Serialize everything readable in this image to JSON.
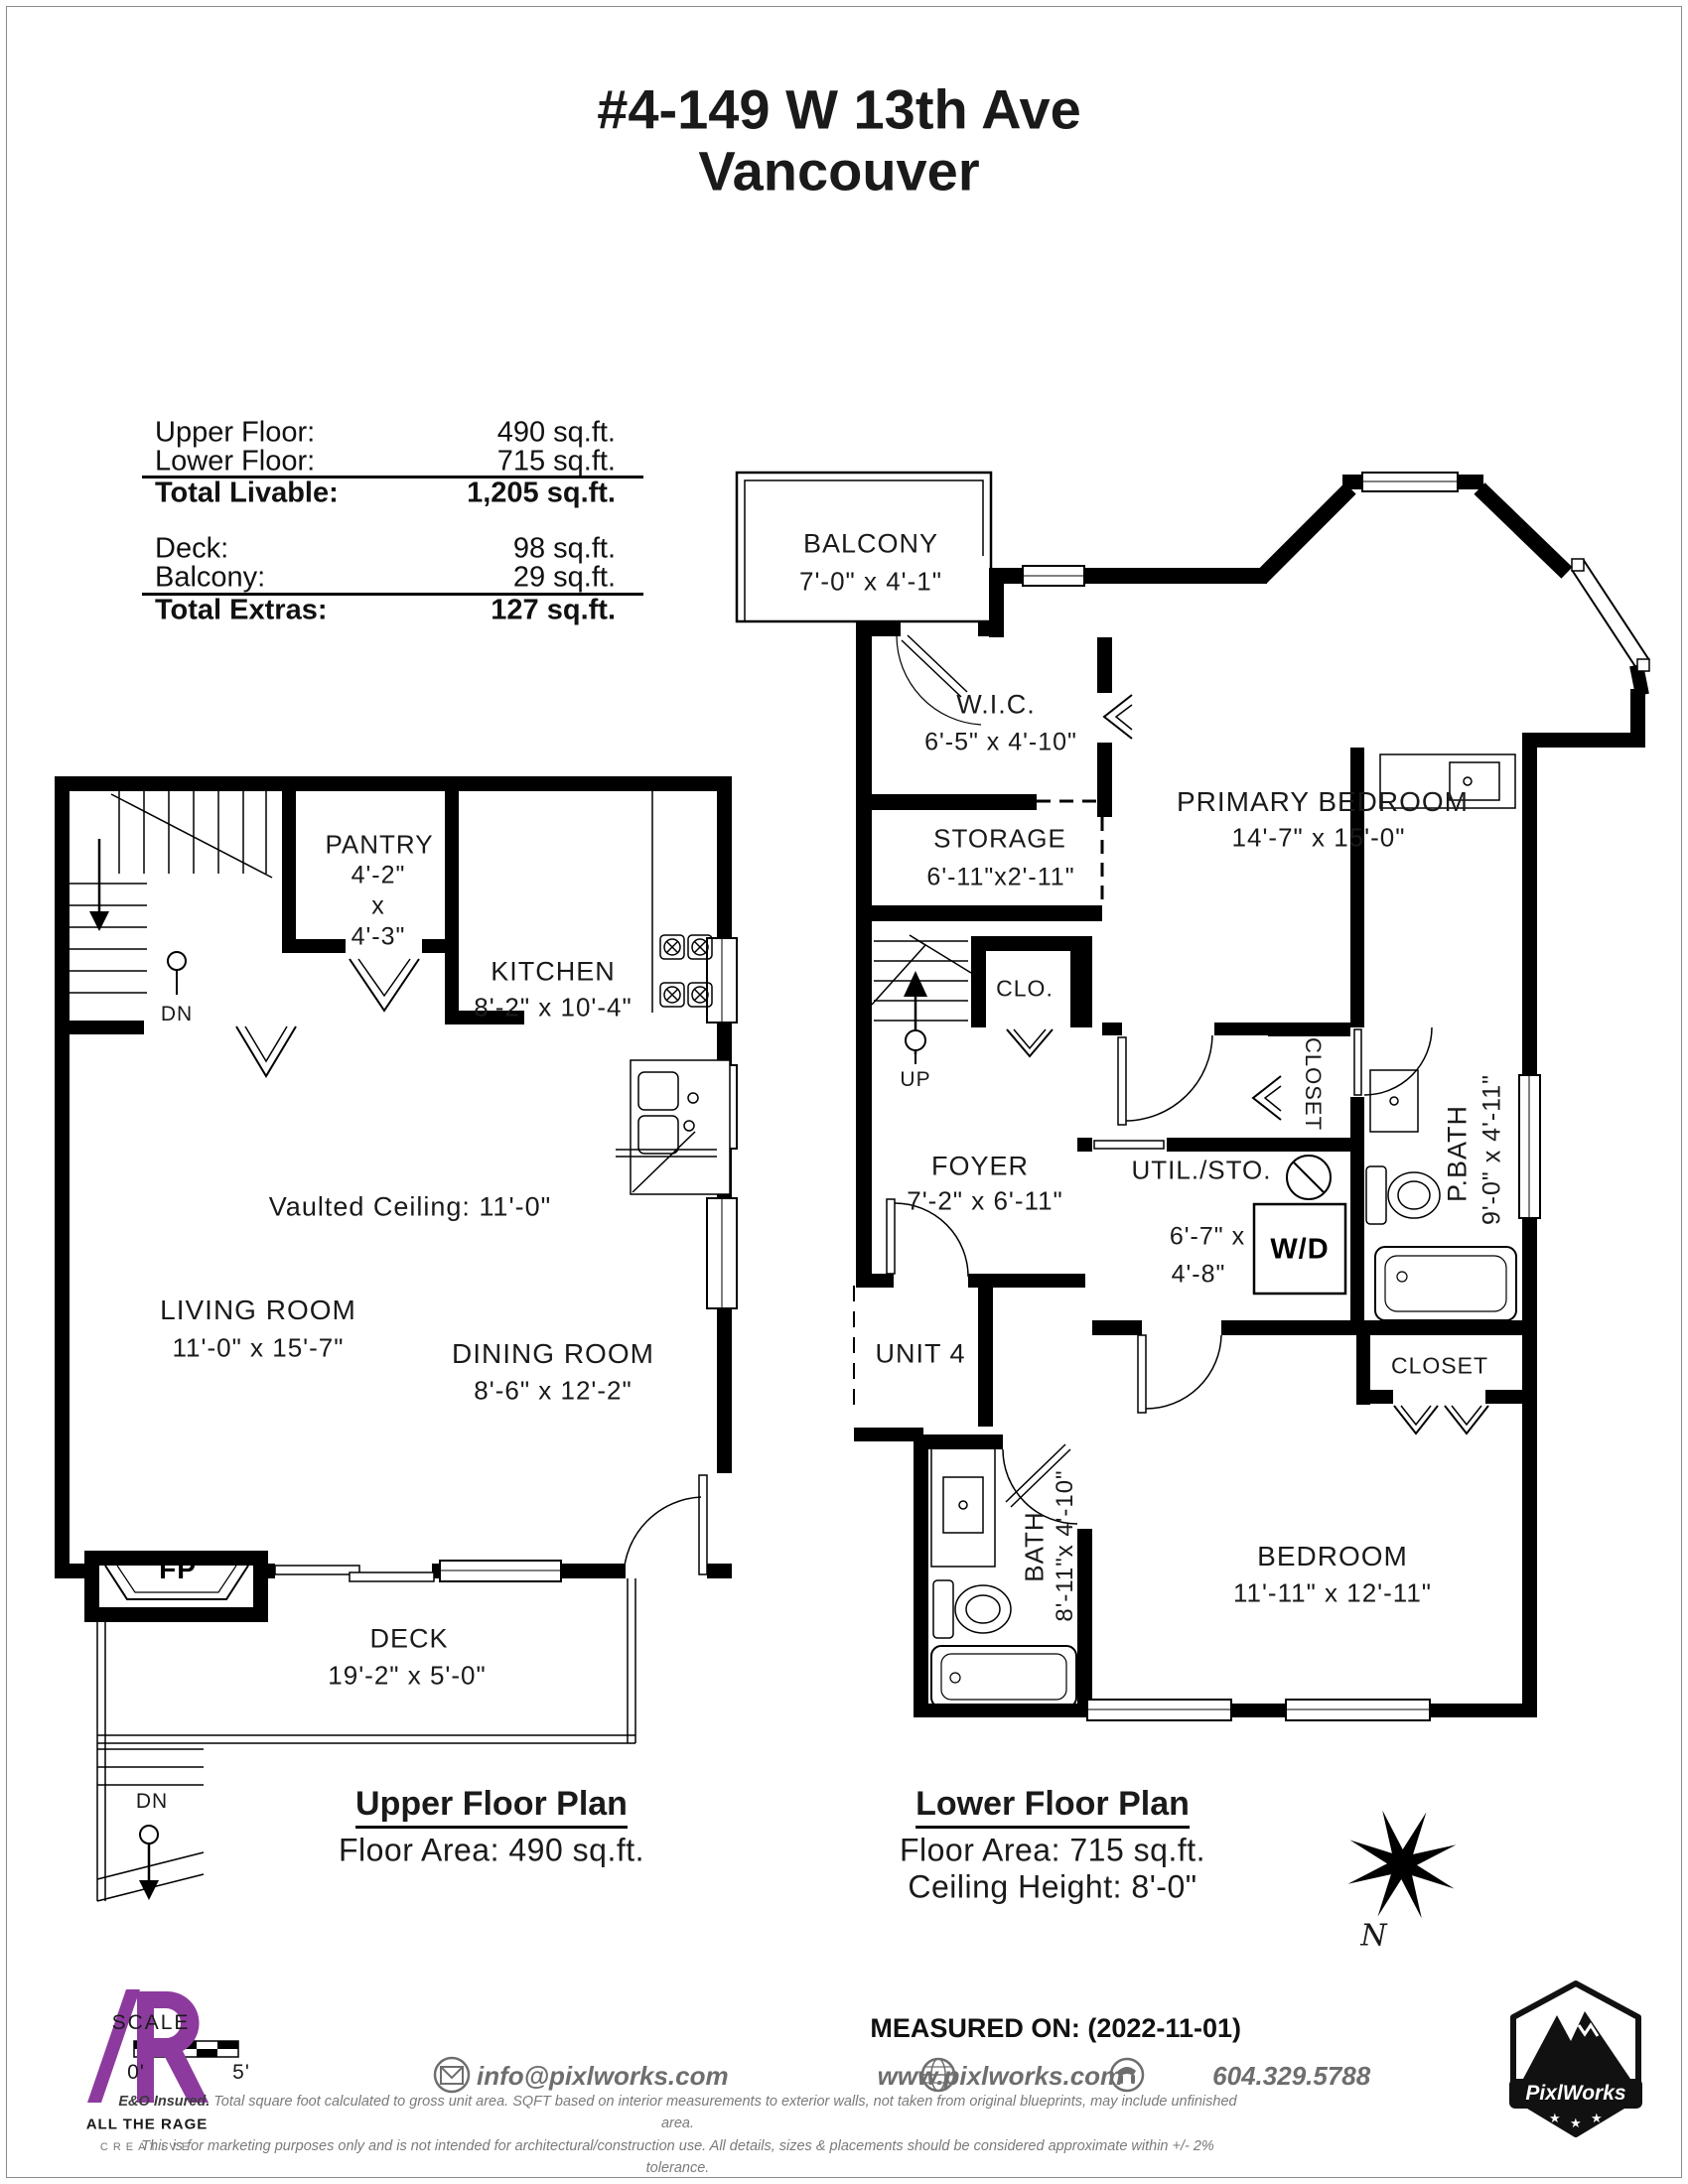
{
  "title": {
    "line1": "#4-149 W 13th Ave",
    "line2": "Vancouver"
  },
  "area_table": {
    "upper_floor_label": "Upper Floor:",
    "upper_floor_value": "490 sq.ft.",
    "lower_floor_label": "Lower Floor:",
    "lower_floor_value": "715 sq.ft.",
    "total_livable_label": "Total Livable:",
    "total_livable_value": "1,205 sq.ft.",
    "deck_label": "Deck:",
    "deck_value": "98 sq.ft.",
    "balcony_label": "Balcony:",
    "balcony_value": "29 sq.ft.",
    "total_extras_label": "Total Extras:",
    "total_extras_value": "127 sq.ft."
  },
  "upper_plan": {
    "title": "Upper Floor Plan",
    "area": "Floor Area: 490 sq.ft.",
    "pantry_name": "PANTRY",
    "pantry_d1": "4'-2\"",
    "pantry_x": "x",
    "pantry_d2": "4'-3\"",
    "kitchen_name": "KITCHEN",
    "kitchen_dims": "8'-2\" x 10'-4\"",
    "living_name": "LIVING ROOM",
    "living_dims": "11'-0\" x 15'-7\"",
    "dining_name": "DINING ROOM",
    "dining_dims": "8'-6\" x 12'-2\"",
    "deck_name": "DECK",
    "deck_dims": "19'-2\" x 5'-0\"",
    "vaulted": "Vaulted Ceiling: 11'-0\"",
    "fireplace": "FP",
    "dn_stairs": "DN",
    "dn_deck": "DN"
  },
  "lower_plan": {
    "title": "Lower Floor Plan",
    "area": "Floor Area: 715 sq.ft.",
    "ceiling": "Ceiling Height: 8'-0\"",
    "balcony_name": "BALCONY",
    "balcony_dims": "7'-0\" x 4'-1\"",
    "wic_name": "W.I.C.",
    "wic_dims": "6'-5\" x 4'-10\"",
    "storage_name": "STORAGE",
    "storage_dims": "6'-11\"x2'-11\"",
    "primary_name": "PRIMARY BEDROOM",
    "primary_dims": "14'-7\" x 15'-0\"",
    "foyer_name": "FOYER",
    "foyer_dims": "7'-2\" x 6'-11\"",
    "util_name": "UTIL./STO.",
    "util_dims_1": "6'-7\" x",
    "util_dims_2": "4'-8\"",
    "wd": "W/D",
    "closet_pbath": "CLOSET",
    "pbath_name": "P.BATH",
    "pbath_dims": "9'-0\" x 4'-11\"",
    "unit": "UNIT 4",
    "bath_name": "BATH",
    "bath_dims": "8'-11\"x 4'-10\"",
    "closet_bedroom": "CLOSET",
    "bedroom_name": "BEDROOM",
    "bedroom_dims": "11'-11\" x 12'-11\"",
    "clo": "CLO.",
    "up_stairs": "UP",
    "compass_north": "N"
  },
  "footer": {
    "scale_label": "SCALE",
    "scale_zero": "0'",
    "scale_five": "5'",
    "agency_line1": "ALL THE RAGE",
    "agency_line2": "CREATIVE",
    "measured_on": "MEASURED ON: (2022-11-01)",
    "email": "info@pixlworks.com",
    "website": "www.pixlworks.com",
    "phone": "604.329.5788",
    "brand": "PixlWorks",
    "disclaimer1_lead": "E&O Insured.",
    "disclaimer1": "Total square foot calculated to gross unit area. SQFT based on interior measurements to exterior walls, not taken from original blueprints, may include unfinished area.",
    "disclaimer2": "This is for marketing purposes only and is not intended for architectural/construction use.  All details, sizes & placements should be considered approximate within +/- 2% tolerance."
  }
}
